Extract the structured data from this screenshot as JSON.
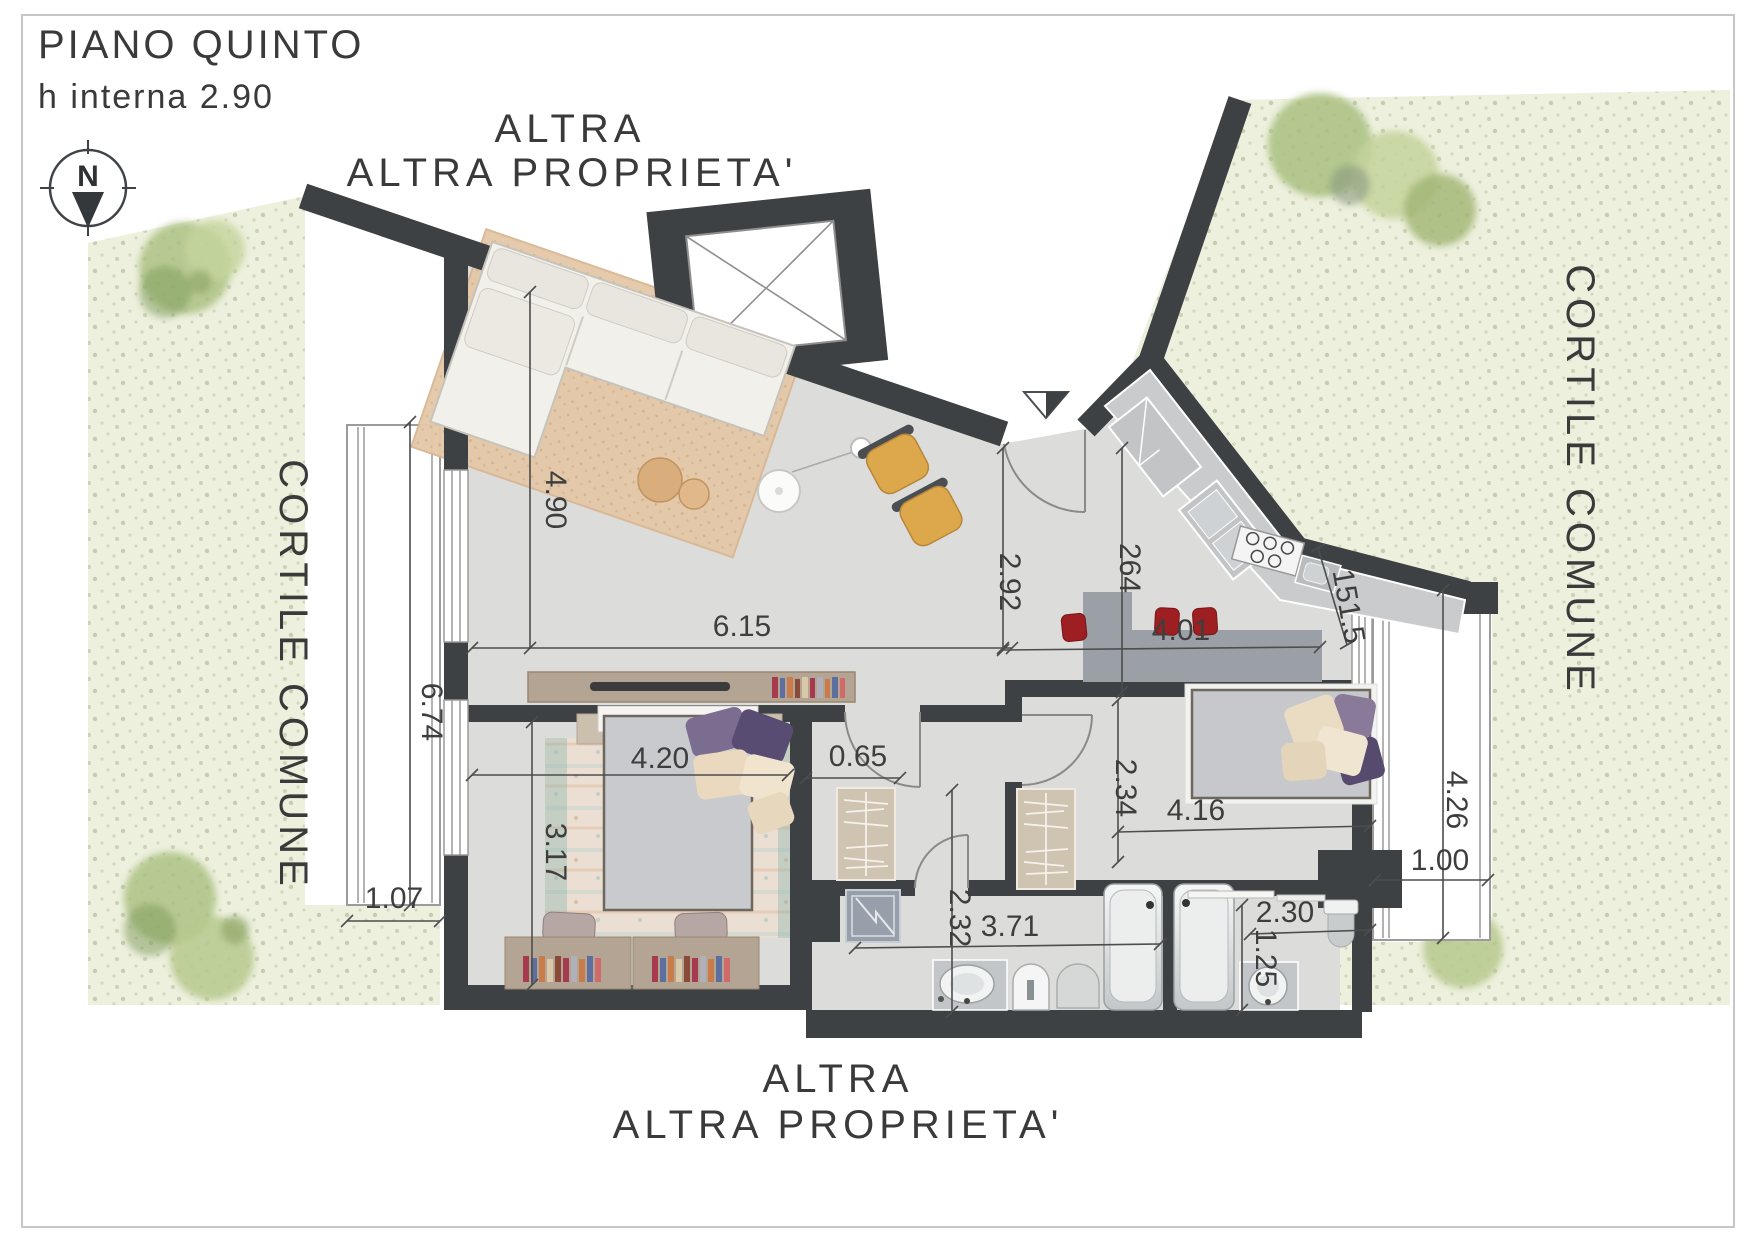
{
  "header": {
    "title": "PIANO QUINTO",
    "subtitle": "h interna 2.90"
  },
  "compass": {
    "north_label": "N"
  },
  "area_labels": {
    "top": "ALTRA PROPRIETA'",
    "bottom": "ALTRA PROPRIETA'",
    "left": "CORTILE COMUNE",
    "right": "CORTILE COMUNE"
  },
  "dimensions": {
    "living_depth": "4.90",
    "living_width": "6.15",
    "entry_corridor": "2.92",
    "kitchen_corridor": "264",
    "kitchen_table_width": "4.01",
    "kitchen_wall": "151.5",
    "balcony_left_length": "6.74",
    "balcony_left_depth": "1.07",
    "bedroom1_depth": "3.17",
    "bedroom1_width": "4.20",
    "hall_nook": "0.65",
    "bathroom1_depth": "2.32",
    "bathroom1_width": "3.71",
    "bedroom2_depth": "2.34",
    "bedroom2_width": "4.16",
    "bathroom2_width": "2.30",
    "bathroom2_depth": "1.25",
    "balcony_right_length": "4.26",
    "balcony_right_depth": "1.00"
  },
  "colors": {
    "wall": "#3d4144",
    "floor": "#dcdddb",
    "courtyard": "#edf0dd",
    "accent_red": "#9e1f22",
    "armchair_yellow": "#dca84b",
    "wood": "#b3a493"
  }
}
